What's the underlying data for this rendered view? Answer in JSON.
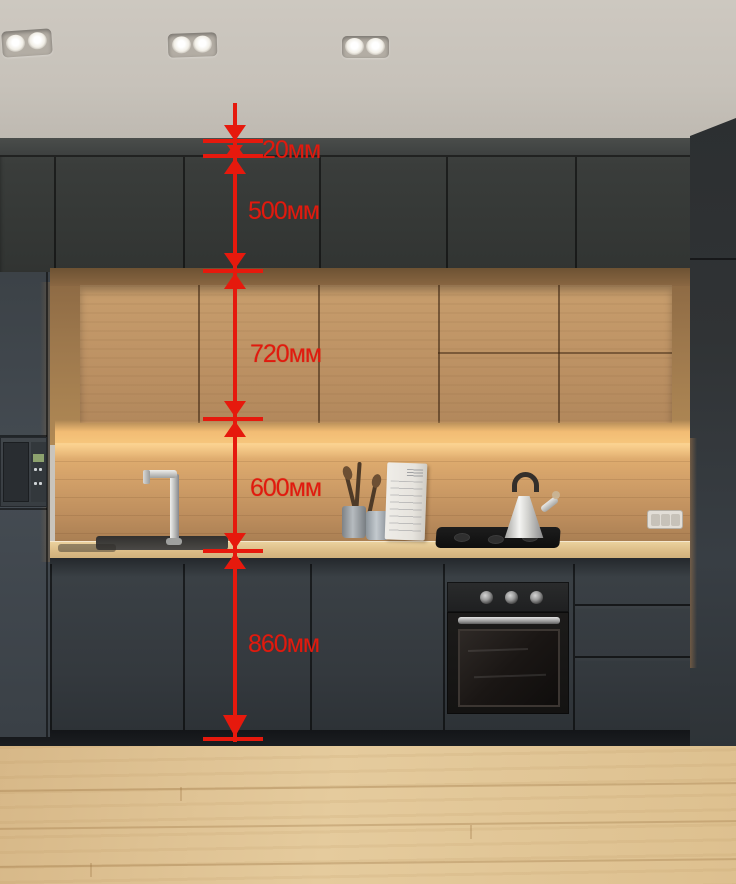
{
  "annotation": {
    "unit": "мм",
    "line_color": "#e6190d",
    "measurements": [
      {
        "id": "ceiling-gap",
        "label": "20мм",
        "value": 20
      },
      {
        "id": "upper-dark-cabinet",
        "label": "500мм",
        "value": 500
      },
      {
        "id": "wood-wall-cabinet",
        "label": "720мм",
        "value": 720
      },
      {
        "id": "backsplash-height",
        "label": "600мм",
        "value": 600
      },
      {
        "id": "base-cabinet",
        "label": "860мм",
        "value": 860
      }
    ]
  },
  "scene": {
    "type": "kitchen-photo-with-dimension-annotations",
    "objects": [
      "ceiling-spotlights",
      "dark-upper-cabinets",
      "wood-wall-cabinets-with-led-strip",
      "wood-backsplash",
      "built-in-microwave",
      "chrome-faucet",
      "undermount-sink",
      "utensil-crocks",
      "notepad",
      "black-cooktop",
      "chrome-kettle",
      "power-outlet",
      "built-in-oven",
      "drawer-unit",
      "dark-base-cabinets",
      "light-wood-floor"
    ],
    "palette": {
      "cabinet_dark": "#34383b",
      "wood_cabinet": "#bd9264",
      "countertop": "#dcbd87",
      "floor": "#e0c494",
      "ceiling": "#c9c4bc",
      "annotation_red": "#e6190d",
      "led_glow": "#f7c87e"
    }
  }
}
